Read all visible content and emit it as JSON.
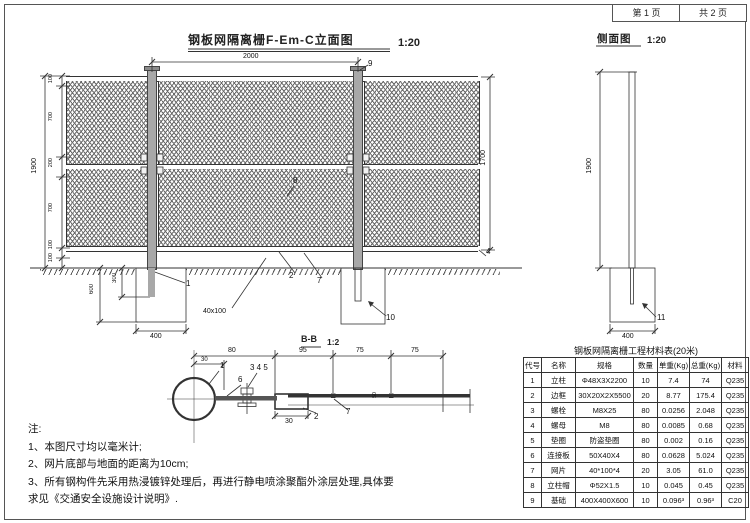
{
  "meta": {
    "page": "第 1 页",
    "pages": "共 2 页"
  },
  "elevation": {
    "title": "钢板网隔离栅F-Em-C立面图",
    "scale": "1:20",
    "dims": {
      "span": "2000",
      "height_total": "1900",
      "left_chain": [
        "100",
        "700",
        "200",
        "700",
        "100",
        "100"
      ],
      "panel_height": "1700",
      "foundation_depth": "600",
      "post_embed": "300",
      "foundation_width": "400",
      "mesh_size": "40x100"
    },
    "labels": {
      "post_cap": "9",
      "post": "1",
      "frame": "2",
      "mesh": "7",
      "mid": "8",
      "rail": "4",
      "foundation": "10"
    }
  },
  "side_view": {
    "title": "侧面图",
    "scale": "1:20",
    "dims": {
      "height": "1900",
      "foundation_width": "400"
    },
    "labels": {
      "foundation": "11"
    }
  },
  "section": {
    "title": "B-B",
    "scale": "1:2",
    "dims": {
      "d30": "30",
      "d80": "80",
      "d95": "95",
      "d75a": "75",
      "d75b": "75",
      "frame_width": "30",
      "mesh_offset": "50"
    },
    "labels": {
      "post": "1",
      "plate": "6",
      "bolt_set": "3 4 5",
      "frame": "2",
      "mesh": "7"
    }
  },
  "notes": {
    "heading": "注:",
    "lines": [
      "1、本图尺寸均以毫米计;",
      "2、网片底部与地面的距离为10cm;",
      "3、所有钢构件先采用热浸镀锌处理后，再进行静电喷涂聚酯外涂层处理,具体要",
      "求见《交通安全设施设计说明》."
    ]
  },
  "materials_table": {
    "title": "钢板网隔离栅工程材料表(20米)",
    "headers": [
      "代号",
      "名称",
      "规格",
      "数量",
      "单重(Kg)",
      "总重(Kg)",
      "材料"
    ],
    "rows": [
      [
        "1",
        "立柱",
        "Φ48X3X2200",
        "10",
        "7.4",
        "74",
        "Q235"
      ],
      [
        "2",
        "边框",
        "30X20X2X5500",
        "20",
        "8.77",
        "175.4",
        "Q235"
      ],
      [
        "3",
        "螺栓",
        "M8X25",
        "80",
        "0.0256",
        "2.048",
        "Q235"
      ],
      [
        "4",
        "螺母",
        "M8",
        "80",
        "0.0085",
        "0.68",
        "Q235"
      ],
      [
        "5",
        "垫圈",
        "防盗垫圈",
        "80",
        "0.002",
        "0.16",
        "Q235"
      ],
      [
        "6",
        "连接板",
        "50X40X4",
        "80",
        "0.0628",
        "5.024",
        "Q235"
      ],
      [
        "7",
        "网片",
        "40*100*4",
        "20",
        "3.05",
        "61.0",
        "Q235"
      ],
      [
        "8",
        "立柱帽",
        "Φ52X1.5",
        "10",
        "0.045",
        "0.45",
        "Q235"
      ],
      [
        "9",
        "基础",
        "400X400X600",
        "10",
        "0.096³",
        "0.96³",
        "C20"
      ]
    ]
  },
  "colors": {
    "line": "#333333",
    "post_fill": "#a8a8a8",
    "mesh_line": "#6a6a6a"
  }
}
